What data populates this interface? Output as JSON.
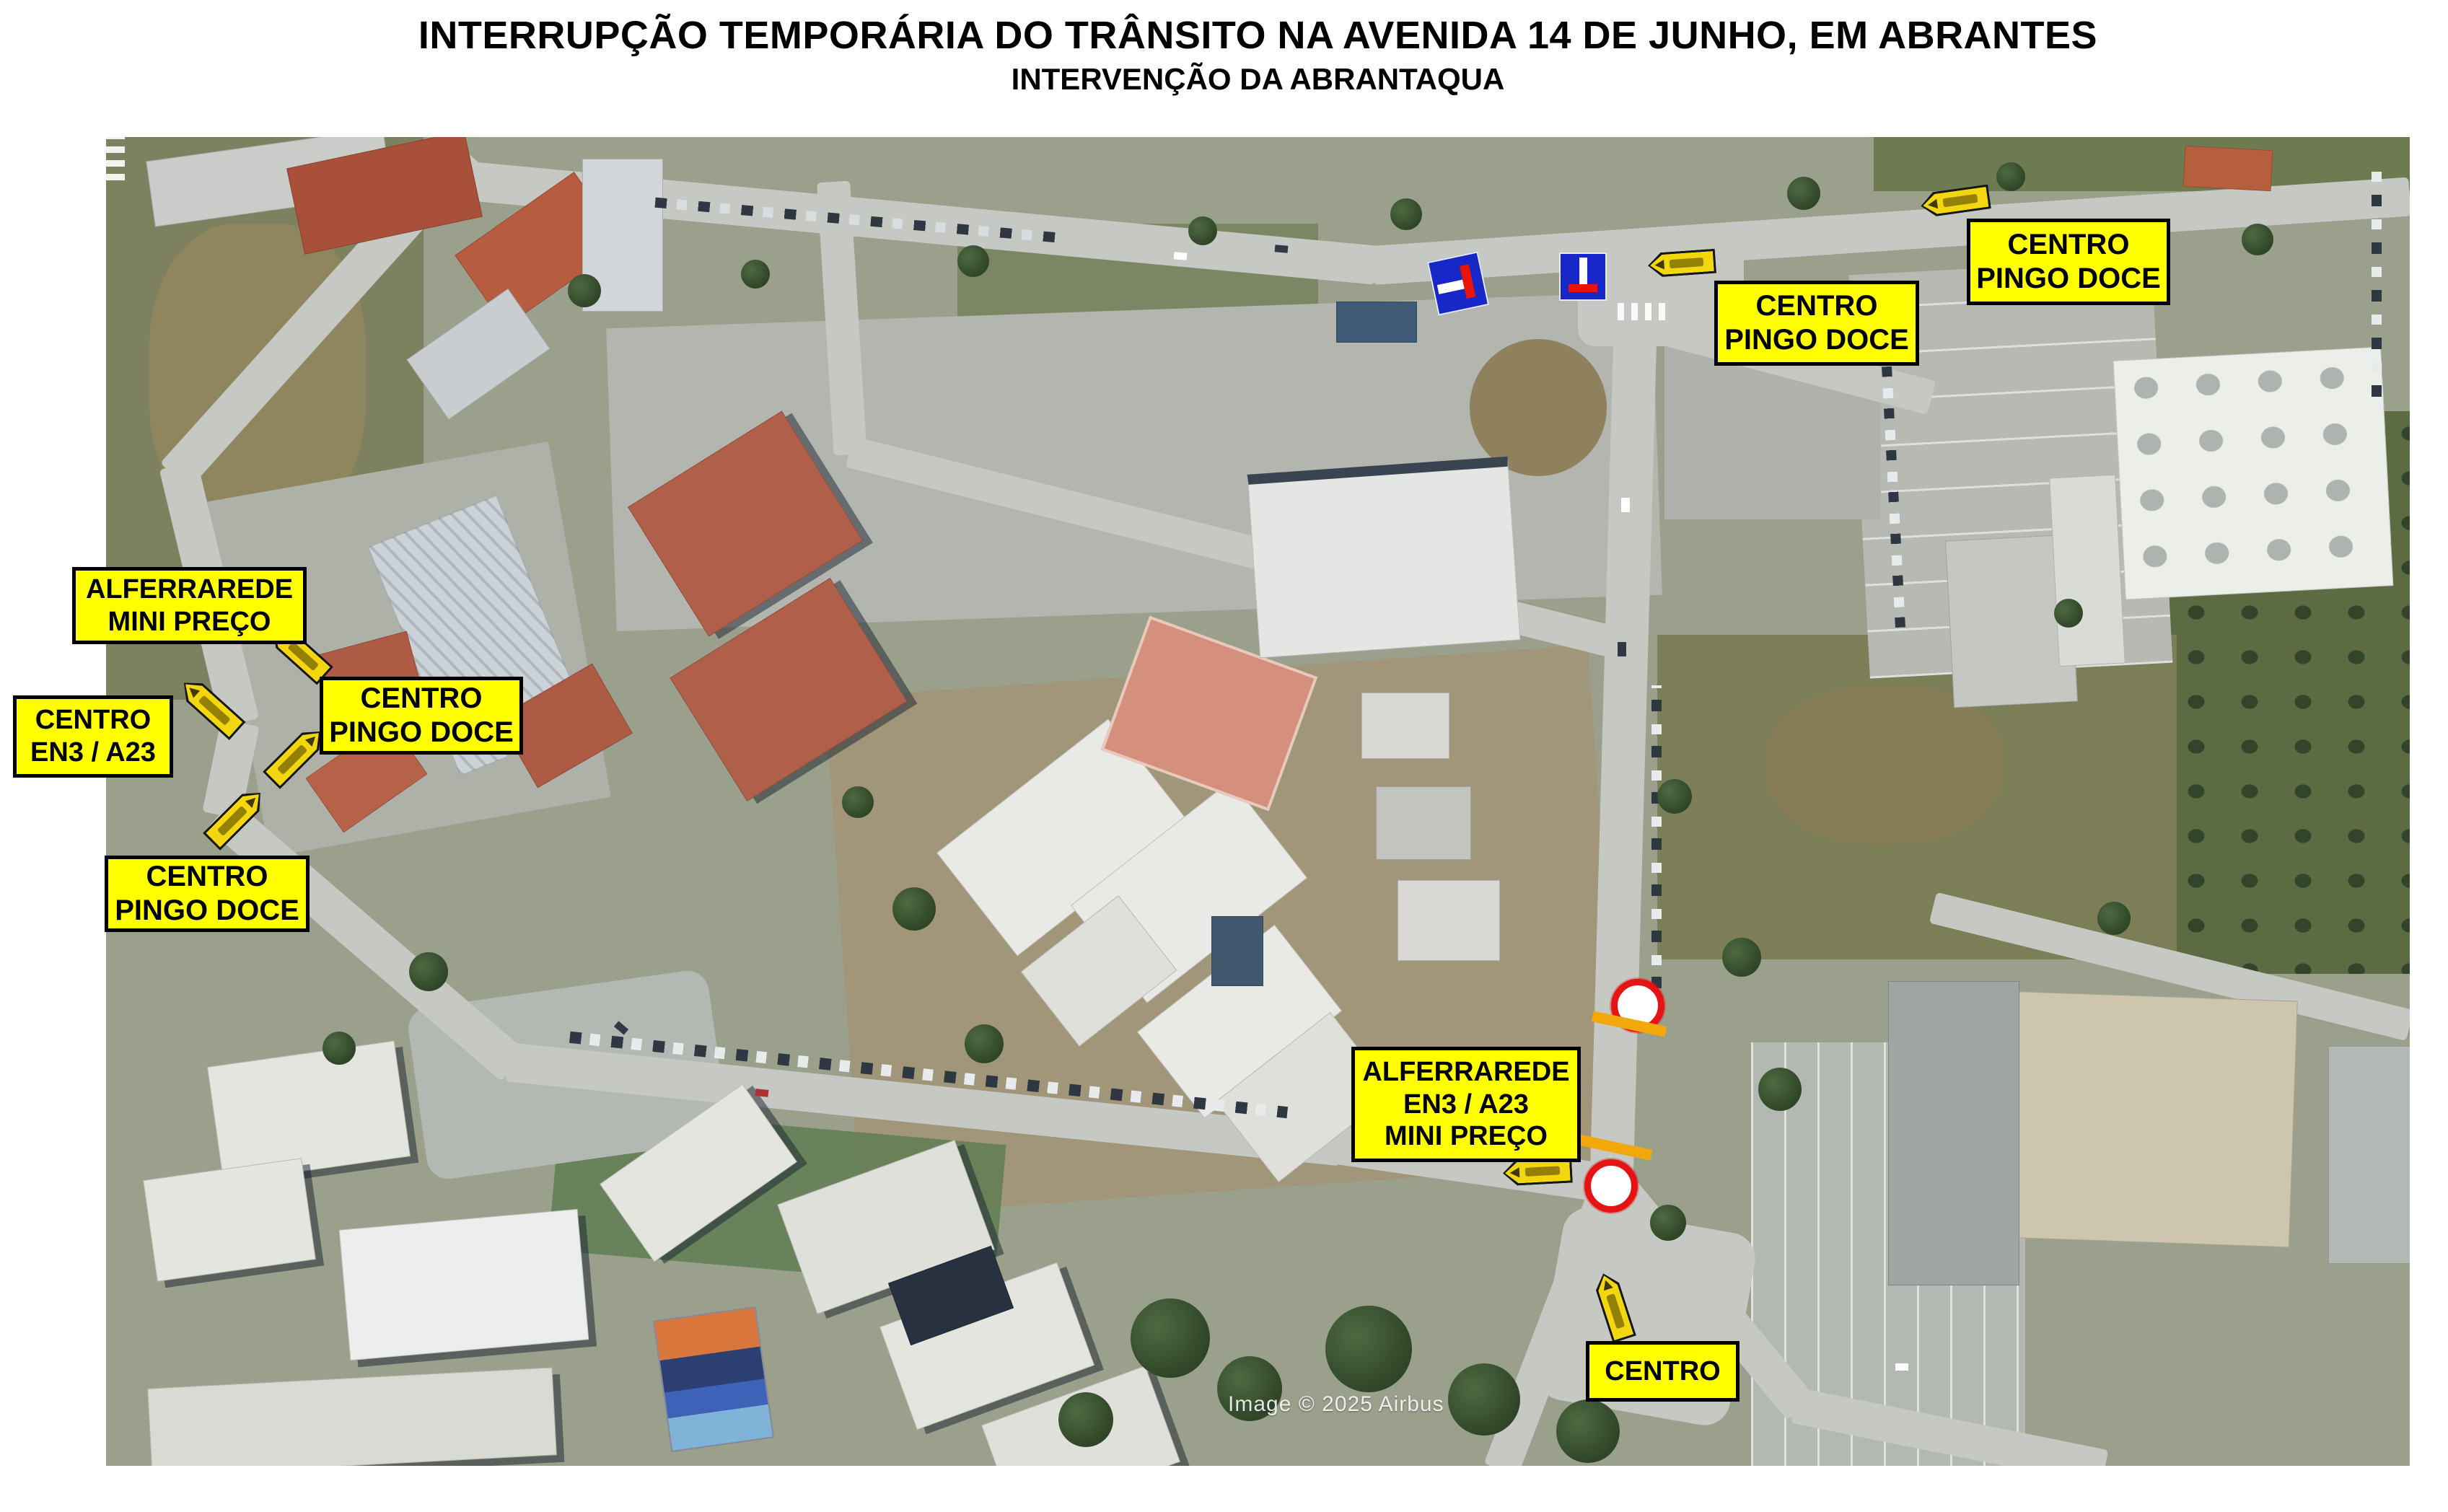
{
  "header": {
    "title": "INTERRUPÇÃO TEMPORÁRIA DO TRÂNSITO NA AVENIDA 14 DE JUNHO, EM ABRANTES",
    "subtitle": "INTERVENÇÃO DA ABRANTAQUA"
  },
  "map": {
    "attribution": "Image © 2025 Airbus",
    "labels": [
      {
        "id": "centro-pingo-doce-top-right",
        "lines": [
          "CENTRO",
          "PINGO DOCE"
        ]
      },
      {
        "id": "centro-pingo-doce-top",
        "lines": [
          "CENTRO",
          "PINGO DOCE"
        ]
      },
      {
        "id": "alferrarede-mini-preco",
        "lines": [
          "ALFERRAREDE",
          "MINI PREÇO"
        ]
      },
      {
        "id": "centro-en3-a23",
        "lines": [
          "CENTRO",
          "EN3 / A23"
        ]
      },
      {
        "id": "centro-pingo-doce-left",
        "lines": [
          "CENTRO",
          "PINGO DOCE"
        ]
      },
      {
        "id": "centro-pingo-doce-center",
        "lines": [
          "CENTRO",
          "PINGO DOCE"
        ]
      },
      {
        "id": "alferrarede-en3-a23-mini-preco",
        "lines": [
          "ALFERRAREDE",
          "EN3 / A23",
          "MINI PREÇO"
        ]
      },
      {
        "id": "centro-bottom",
        "lines": [
          "CENTRO"
        ]
      }
    ],
    "icons": {
      "no_through_road_sign": "blue square, white bar, red end-bar",
      "direction_arrow_sign": "yellow left-pointing arrow plate",
      "road_closed_marker": "white circle with red ring",
      "closure_bar": "orange diagonal bar"
    },
    "colors": {
      "label_bg": "#ffff00",
      "label_border": "#000000",
      "closure_ring": "#e51313",
      "closure_bar": "#f2a70a",
      "sign_blue": "#1727c8",
      "sign_red": "#e81309",
      "sign_white": "#ffffff",
      "arrow_plate": "#f2d70e"
    }
  }
}
